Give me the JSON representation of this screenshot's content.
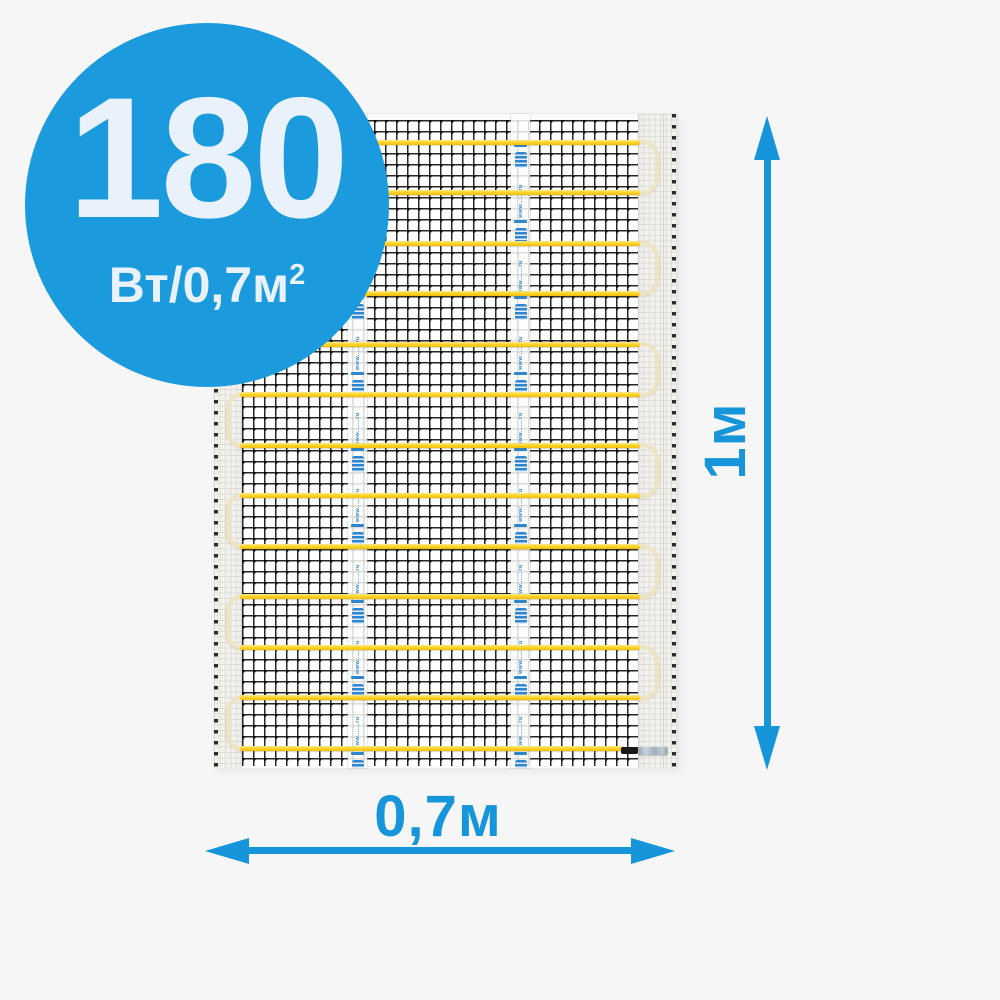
{
  "page": {
    "background": "#f6f6f7"
  },
  "badge": {
    "value": "180",
    "unit_base": "Вт/0,7м",
    "unit_sup": "2",
    "bg_color": "#1b9bdd",
    "text_color": "#e9f1fb"
  },
  "dimensions": {
    "height_label": "1м",
    "width_label": "0,7м",
    "color": "#1795da"
  },
  "mat": {
    "tape_text": "www.......ru",
    "cable_count": 13,
    "colors": {
      "cable": "#ffd62e",
      "loop": "#ece4c2",
      "mesh_line": "#262626",
      "tape_mark": "#2f86d0"
    },
    "layout": {
      "cable_first_top": 25.5,
      "cable_spacing": 50.5,
      "tape_x": [
        134,
        297
      ],
      "tape_cycle_start": 30,
      "tape_cycle_period": 76,
      "tape_cycles": 9
    }
  }
}
